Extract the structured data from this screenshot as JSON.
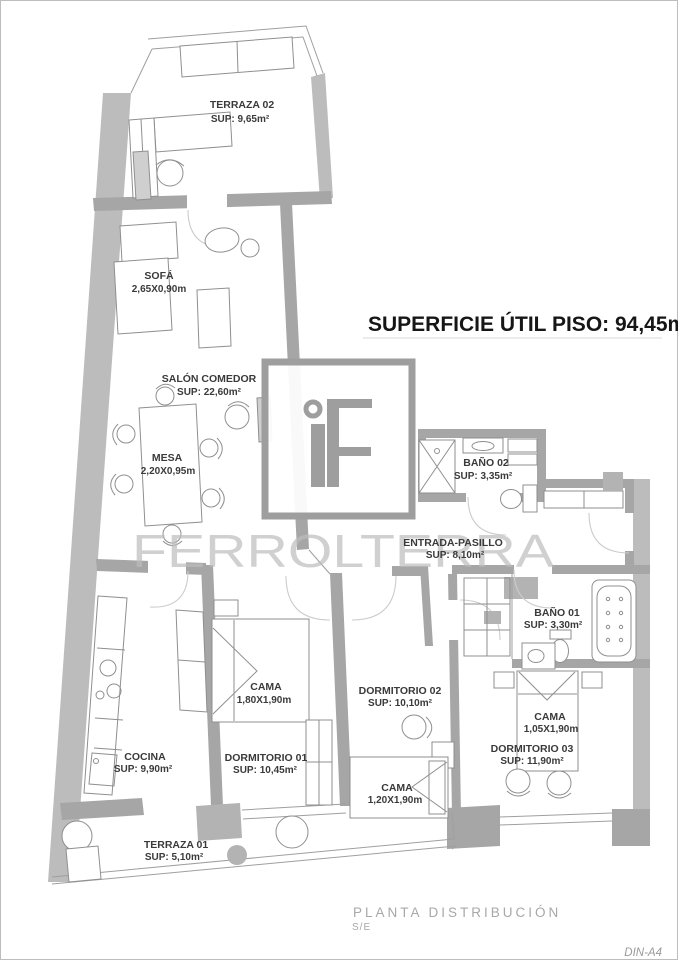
{
  "header": {
    "title": "SUPERFICIE ÚTIL PISO: 94,45m²"
  },
  "watermark": {
    "logo_text": "iF",
    "brand": "FERROLTERRA"
  },
  "rooms": {
    "terraza02": {
      "name": "TERRAZA 02",
      "sup": "SUP: 9,65m²"
    },
    "sofa": {
      "name": "SOFÁ",
      "dim": "2,65X0,90m"
    },
    "salon": {
      "name": "SALÓN COMEDOR",
      "sup": "SUP: 22,60m²"
    },
    "mesa": {
      "name": "MESA",
      "dim": "2,20X0,95m"
    },
    "bano02": {
      "name": "BAÑO 02",
      "sup": "SUP: 3,35m²"
    },
    "entrada": {
      "name": "ENTRADA-PASILLO",
      "sup": "SUP: 8,10m²"
    },
    "bano01": {
      "name": "BAÑO 01",
      "sup": "SUP: 3,30m²"
    },
    "dorm01": {
      "name": "DORMITORIO 01",
      "sup": "SUP: 10,45m²",
      "cama": "CAMA",
      "cama_dim": "1,80X1,90m"
    },
    "dorm02": {
      "name": "DORMITORIO 02",
      "sup": "SUP: 10,10m²",
      "cama": "CAMA",
      "cama_dim": "1,20X1,90m"
    },
    "dorm03": {
      "name": "DORMITORIO 03",
      "sup": "SUP: 11,90m²",
      "cama": "CAMA",
      "cama_dim": "1,05X1,90m"
    },
    "cocina": {
      "name": "COCINA",
      "sup": "SUP: 9,90m²"
    },
    "terraza01": {
      "name": "TERRAZA 01",
      "sup": "SUP: 5,10m²"
    }
  },
  "footer": {
    "plan": "PLANTA DISTRIBUCIÓN",
    "scale": "S/E",
    "sheet": "DIN-A4"
  },
  "colors": {
    "wall": "#a6a6a6",
    "exterior_band": "#bcbcbc",
    "furniture_line": "#8f8f8f",
    "label_text": "#3a3a3a",
    "title_text": "#161616",
    "watermark_gray": "#bdbdbd",
    "footer_gray": "#a8a8a8"
  }
}
